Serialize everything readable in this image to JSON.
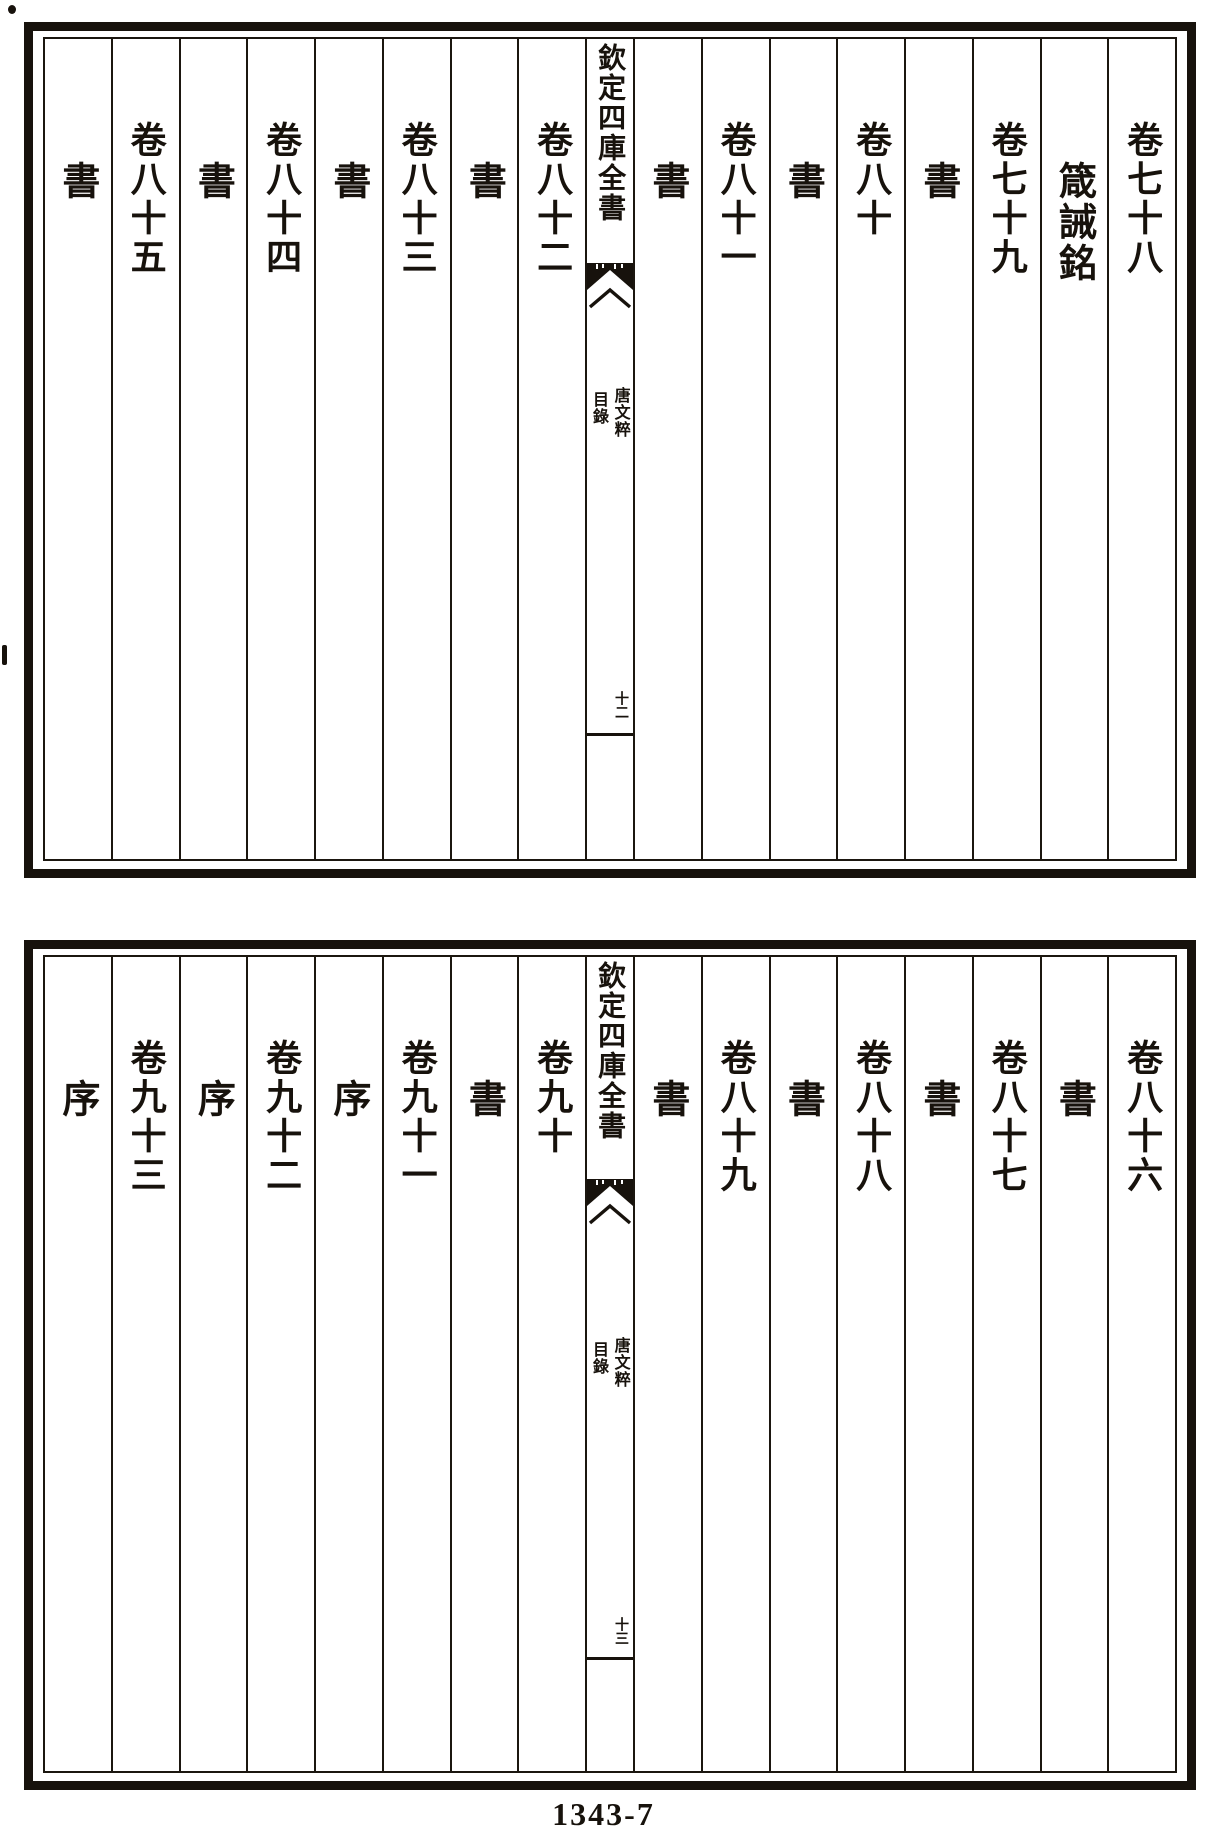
{
  "colors": {
    "ink": "#17120c",
    "paper": "#ffffff"
  },
  "footer": {
    "page_code": "1343-7"
  },
  "pages": [
    {
      "position": "top",
      "center": {
        "series_title": "欽定四庫全書",
        "work_title": "唐文粹",
        "section_label": "目錄",
        "folio": "十二"
      },
      "columns": [
        {
          "label": "卷七十八"
        },
        {
          "label": "箴誡銘"
        },
        {
          "label": "卷七十九"
        },
        {
          "label": "書"
        },
        {
          "label": "卷八十"
        },
        {
          "label": "書"
        },
        {
          "label": "卷八十一"
        },
        {
          "label": "書"
        },
        {
          "label": "卷八十二"
        },
        {
          "label": "書"
        },
        {
          "label": "卷八十三"
        },
        {
          "label": "書"
        },
        {
          "label": "卷八十四"
        },
        {
          "label": "書"
        },
        {
          "label": "卷八十五"
        },
        {
          "label": "書"
        }
      ]
    },
    {
      "position": "bottom",
      "center": {
        "series_title": "欽定四庫全書",
        "work_title": "唐文粹",
        "section_label": "目錄",
        "folio": "十三"
      },
      "columns": [
        {
          "label": "卷八十六"
        },
        {
          "label": "書"
        },
        {
          "label": "卷八十七"
        },
        {
          "label": "書"
        },
        {
          "label": "卷八十八"
        },
        {
          "label": "書"
        },
        {
          "label": "卷八十九"
        },
        {
          "label": "書"
        },
        {
          "label": "卷九十"
        },
        {
          "label": "書"
        },
        {
          "label": "卷九十一"
        },
        {
          "label": "序"
        },
        {
          "label": "卷九十二"
        },
        {
          "label": "序"
        },
        {
          "label": "卷九十三"
        },
        {
          "label": "序"
        }
      ]
    }
  ]
}
